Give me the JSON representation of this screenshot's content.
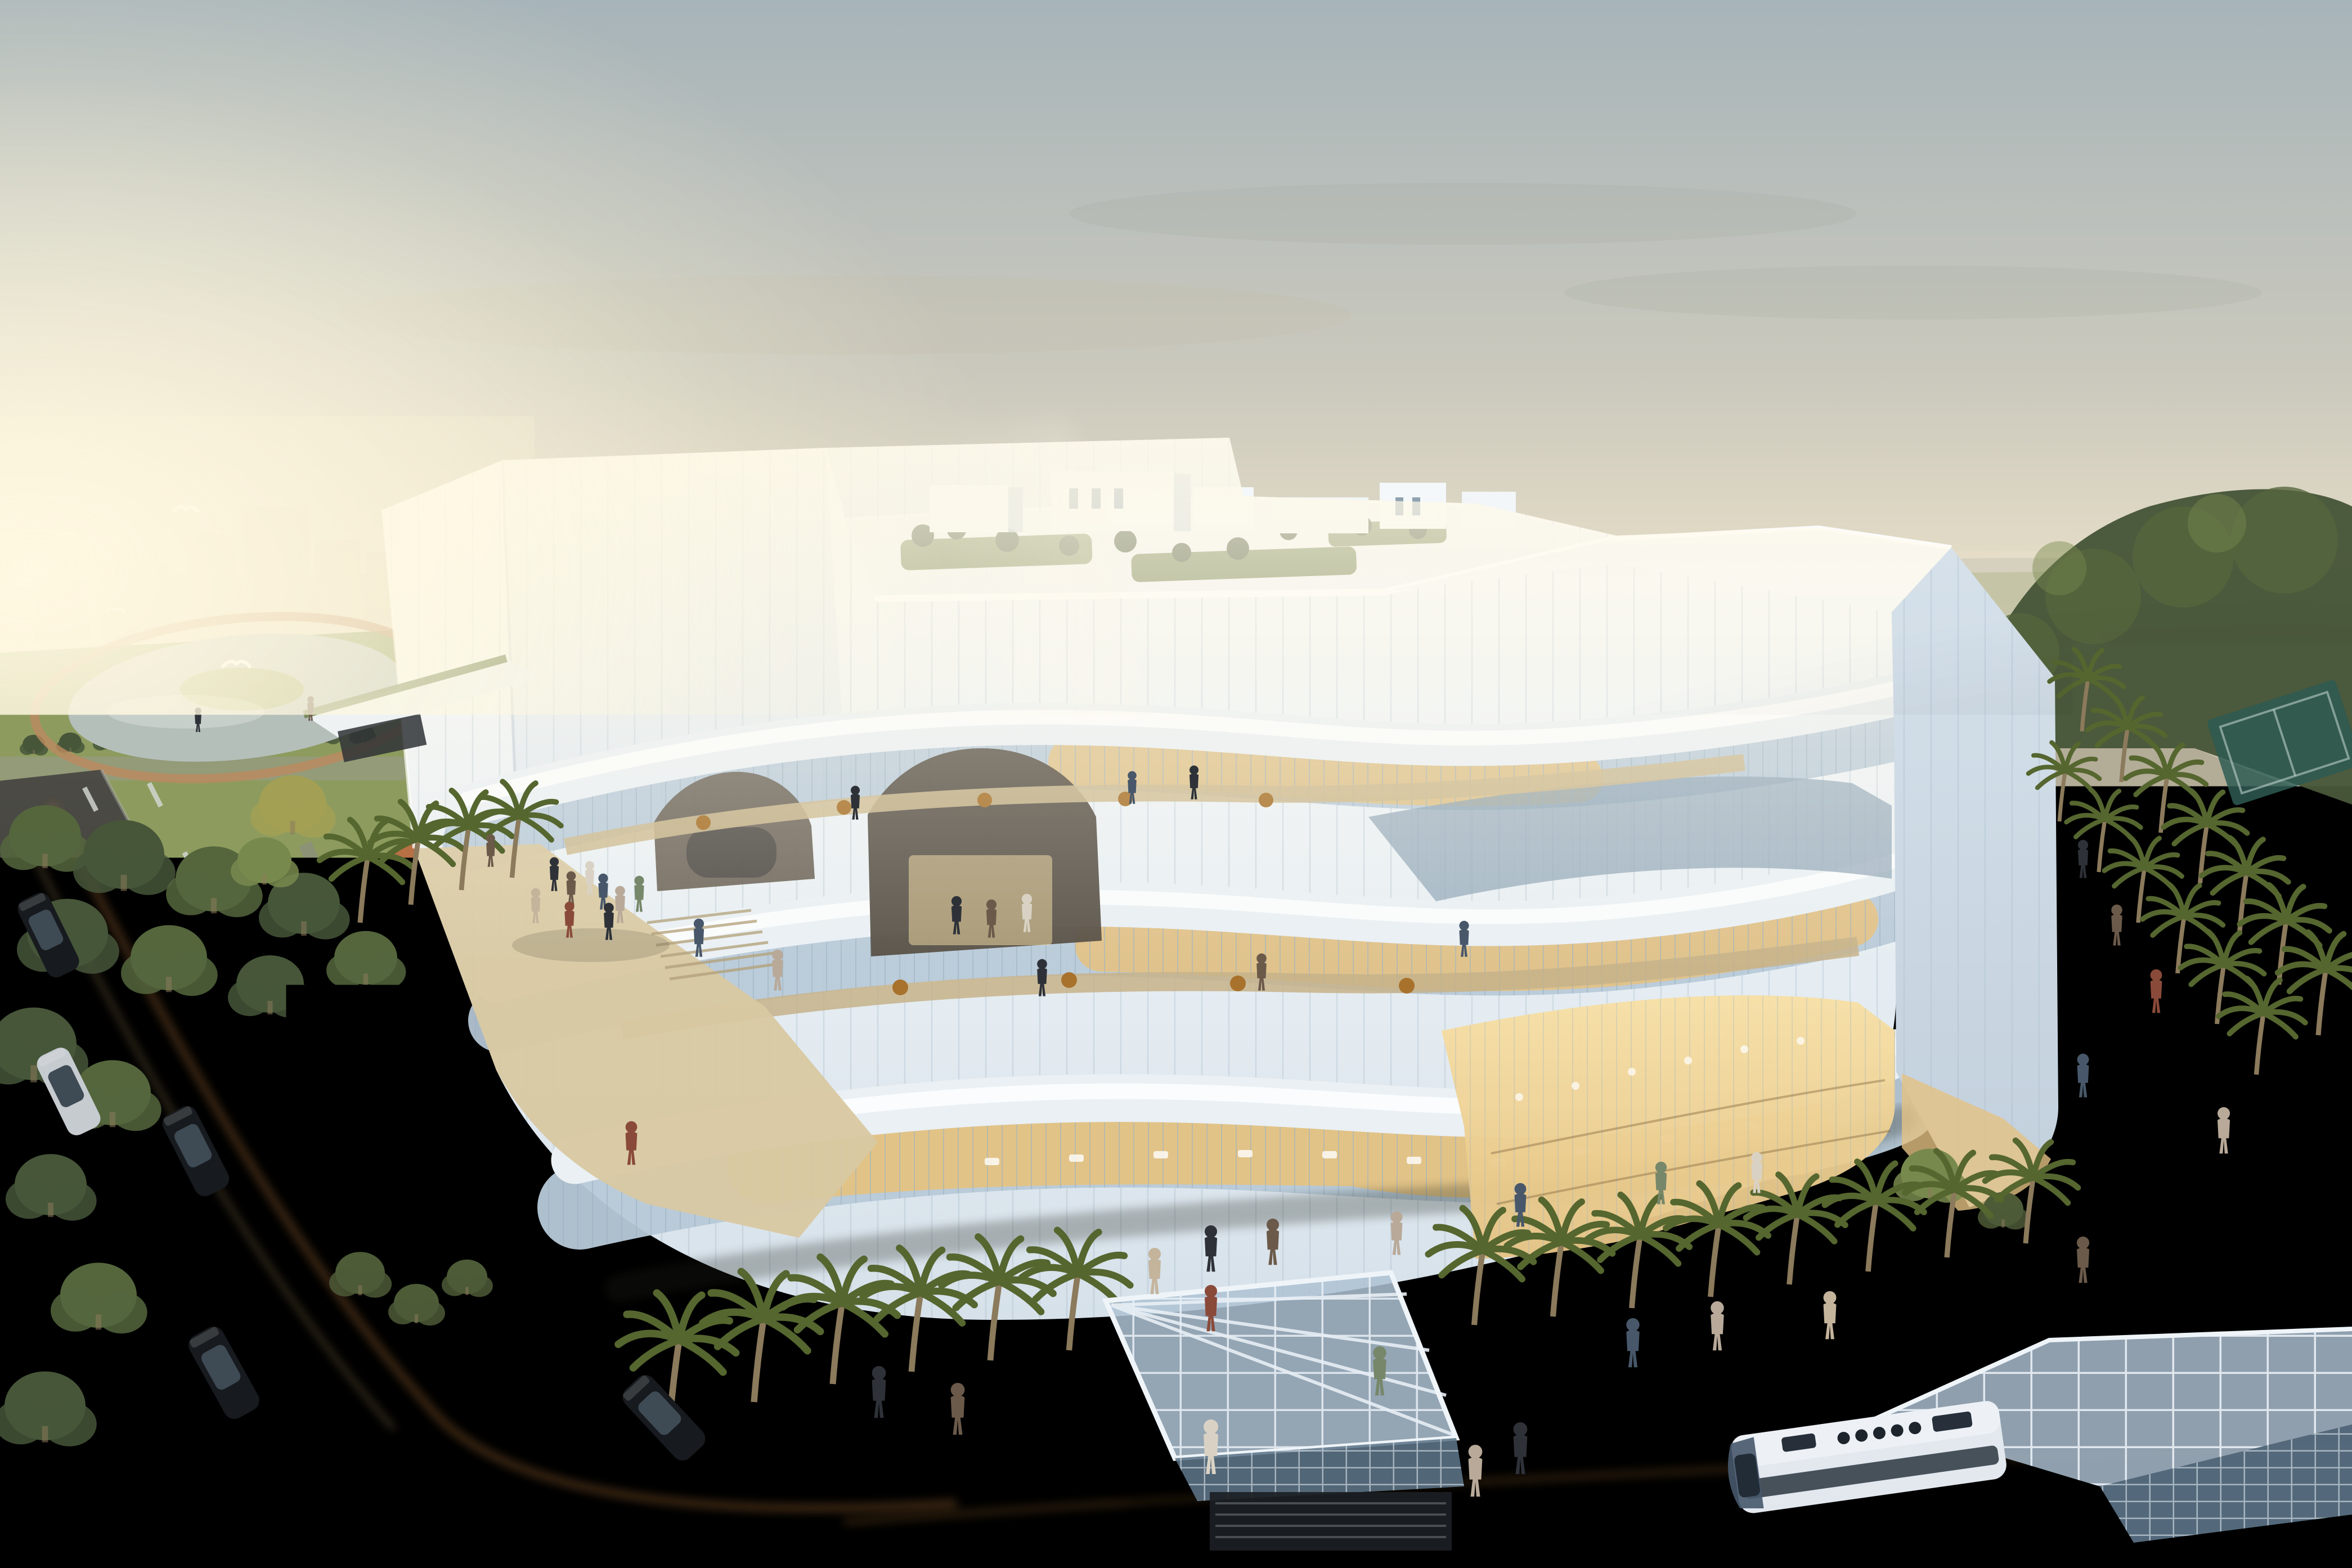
{
  "scene": {
    "type": "architectural-rendering",
    "view": "aerial-dusk-view",
    "elements": [
      "sky",
      "sun-glow",
      "distant-city",
      "distant-fields",
      "park-with-pond",
      "white-curved-building",
      "rooftop-garden",
      "ribbon-terraces",
      "warm-lit-glass",
      "plaza",
      "running-track",
      "palm-trees",
      "trees",
      "roads",
      "cars",
      "bus",
      "glass-canopies",
      "stair-pit",
      "pedestrians",
      "birds"
    ]
  },
  "colors": {
    "sky_top": "#a7b4b9",
    "sky_mid": "#cbc9bd",
    "sky_low": "#e9e0c8",
    "sky_horizon": "#f4ead0",
    "sun_glow": "#fff7d9",
    "glow_white": "#fff9e8",
    "haze": "#e9dfc9",
    "city_block": "#c9b795",
    "far_field": "#a4ab85",
    "far_tree": "#6b775c",
    "far_water": "#ccd4cd",
    "far_hill": "#9aa198",
    "lawn": "#8d9c5e",
    "lawn_dark": "#6f7e4b",
    "pond": "#b5bfba",
    "pond_island": "#9aa768",
    "track_loop": "#bb8a5f",
    "tree1": "#55663d",
    "tree2": "#475639",
    "tree3": "#78894e",
    "tree_yellow": "#a3a055",
    "shrub": "#4d5b37",
    "facade_top": "#f7f9fa",
    "facade": "#eaf0f4",
    "facade_shade": "#d6e1ea",
    "facade_deep": "#c2d0dd",
    "mullion": "#9db2c2",
    "glass_cool": "#b7c9d8",
    "glass_dark": "#8da3b6",
    "glass_warm": "#e4c283",
    "glow": "#f7e0a6",
    "roof_lawn": "#6f7f4c",
    "plaza_sun": "#d6cbac",
    "plaza_mid": "#b3ac97",
    "plaza_shade": "#82847a",
    "track_sun": "#bf6a40",
    "track_shade": "#8e4c31",
    "lawn_strip": "#5d6e41",
    "palm_trunk": "#8b7a5b",
    "palm_frond": "#55662f",
    "road": "#4c4b45",
    "road_dark": "#26292c",
    "lane": "#d6dad6",
    "trail": "#c8823c",
    "car_dark": "#171a1e",
    "car_glass": "#3e4a54",
    "car_silver": "#c6cbd0",
    "bus_white": "#e2e8ee",
    "bus_blue": "#46586c",
    "canopy_frame": "#e9f0f6",
    "canopy_glass": "#aec2d4",
    "canopy_glass_dark": "#5c7488",
    "pit": "#1b1f24",
    "p0": "#2e3238",
    "p1": "#6b5a4a",
    "p2": "#b8a999",
    "p3": "#8a4a3a",
    "p4": "#d9d2c4",
    "p5": "#48586a",
    "p6": "#77876a",
    "p7": "#c4b49c",
    "bird": "#ffffff",
    "dusk": "#0b0f14",
    "court": "#2e5a52"
  }
}
